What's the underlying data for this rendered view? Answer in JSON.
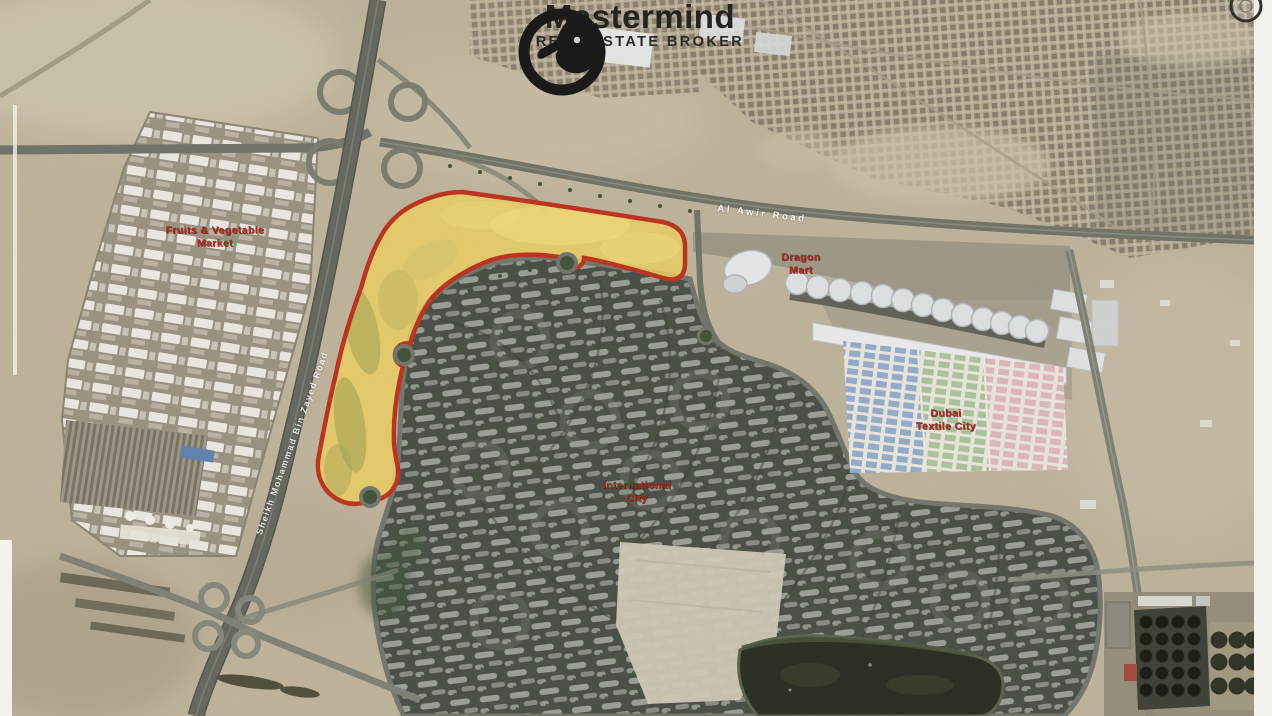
{
  "logo": {
    "name": "Mastermind",
    "tagline": "REAL ESTATE BROKER",
    "icon": "falcon-swoosh-icon"
  },
  "map_labels": {
    "fruits_market": "Fruits & Vegetable\nMarket",
    "dragon_mart": "Dragon\nMart",
    "dubai_textile_city": "Dubai\nTextile City",
    "international_city": "International\nCity",
    "al_awir_road": "Al Awir Road",
    "smbz_road": "Sheikh Mohammad Bin Zayed Road"
  },
  "colors": {
    "sand": "#bdb29a",
    "label_red": "#b5281e",
    "road_label": "#ffffff",
    "plot_fill": "#edd05e",
    "plot_outline": "#bc2f1a"
  }
}
